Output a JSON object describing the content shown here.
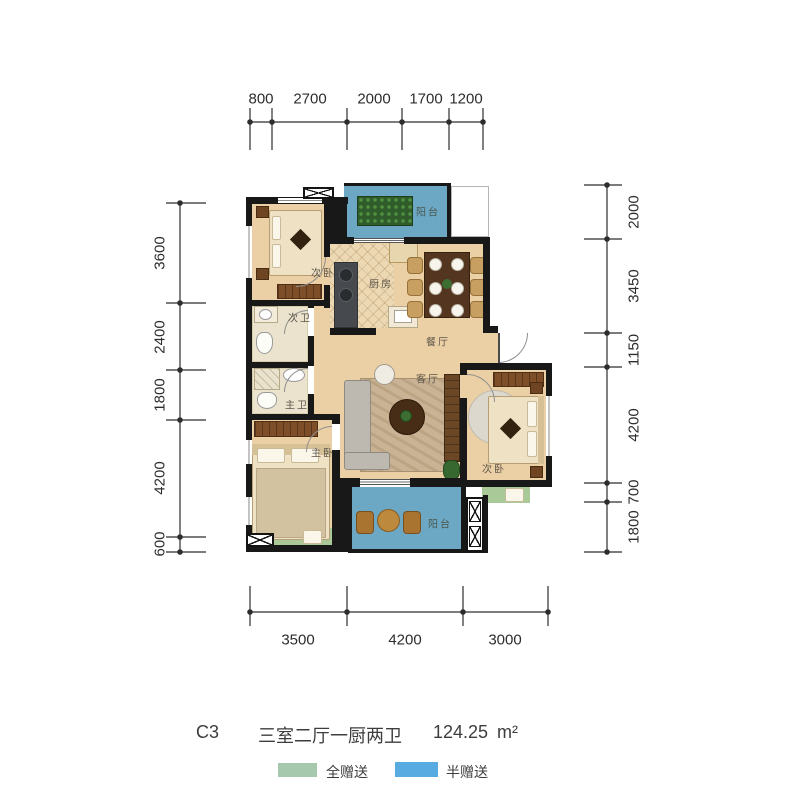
{
  "title": {
    "unit_code": "C3",
    "layout_desc": "三室二厅一厨两卫",
    "area_value": "124.25",
    "area_unit": "m²"
  },
  "legend": {
    "full_gift": {
      "label": "全赠送",
      "color": "#a6c8ad"
    },
    "half_gift": {
      "label": "半赠送",
      "color": "#58abe0"
    }
  },
  "rooms": {
    "bedroom_top": {
      "label": "次卧"
    },
    "bath_second": {
      "label": "次卫"
    },
    "kitchen": {
      "label": "厨房"
    },
    "dining": {
      "label": "餐厅"
    },
    "living": {
      "label": "客厅"
    },
    "bath_master": {
      "label": "主卫"
    },
    "bedroom_master": {
      "label": "主卧"
    },
    "bedroom_right": {
      "label": "次卧"
    },
    "balcony_top": {
      "label": "阳台"
    },
    "balcony_bottom": {
      "label": "阳台"
    }
  },
  "dimensions": {
    "top": [
      "800",
      "2700",
      "2000",
      "1700",
      "1200"
    ],
    "left": [
      "3600",
      "2400",
      "1800",
      "4200",
      "600"
    ],
    "right": [
      "2000",
      "3450",
      "1150",
      "4200",
      "700",
      "1800"
    ],
    "bottom": [
      "3500",
      "4200",
      "3000"
    ]
  },
  "colors": {
    "wall": "#181818",
    "floor": "#ecd0a5",
    "balcony_blue": "#6ca7c3",
    "gift_green": "#a9c998"
  }
}
